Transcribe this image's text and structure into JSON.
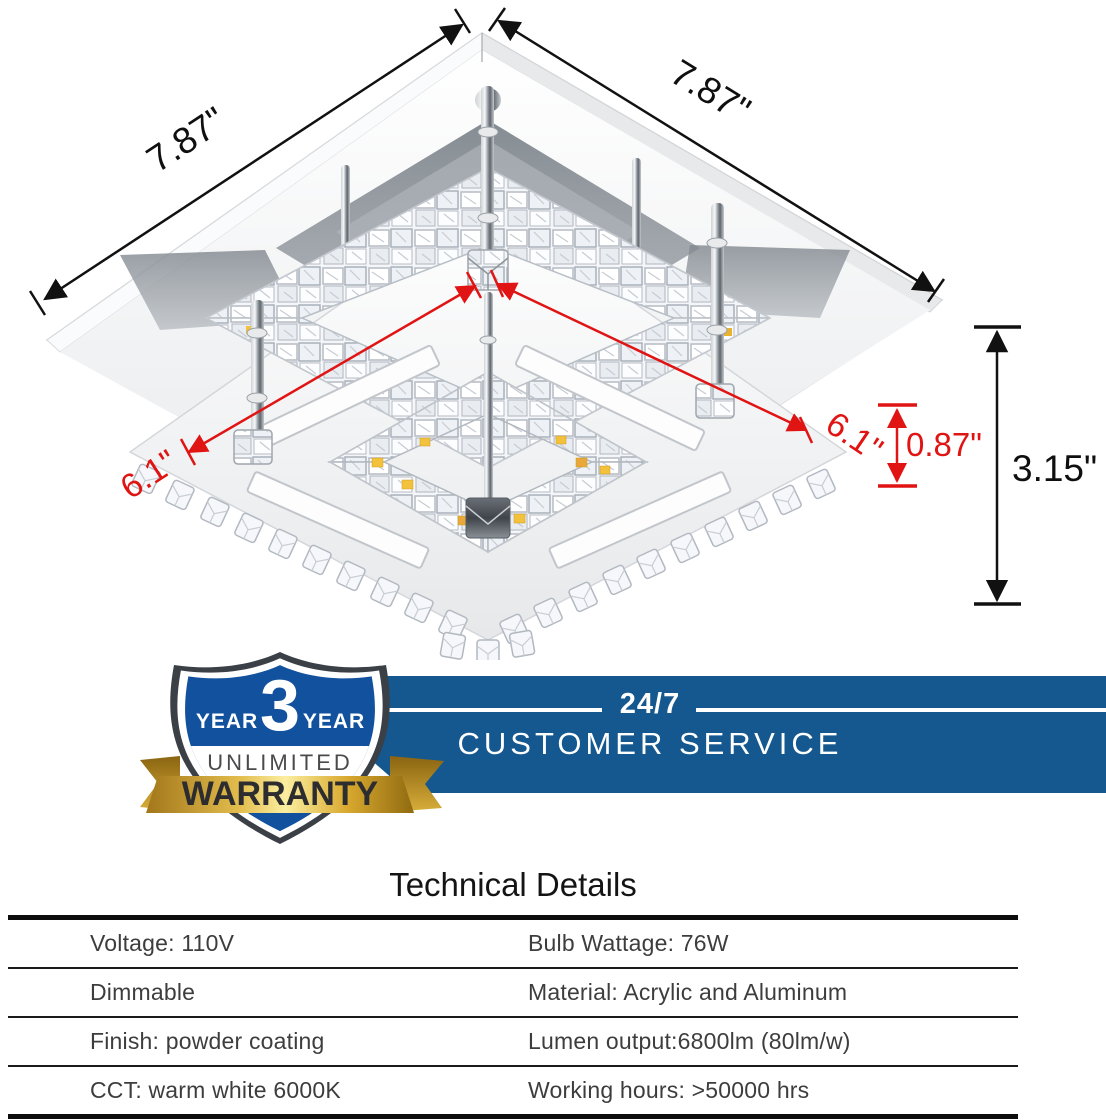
{
  "product_diagram": {
    "description": "crystal-led-flush-mount-ceiling-light",
    "dimensions": {
      "top_left_width": "7.87\"",
      "top_right_depth": "7.87\"",
      "inner_edge_left": "6.1\"",
      "inner_edge_right": "6.1\"",
      "ring_height": "0.87\"",
      "total_height": "3.15\""
    },
    "colors": {
      "dimension_black": "#111111",
      "dimension_red": "#e11414",
      "led_yellow": "#f2c23c",
      "chrome_gray": "#9aa0a6"
    }
  },
  "badge": {
    "year_left": "YEAR",
    "year_number": "3",
    "year_right": "YEAR",
    "line2": "UNLIMITED",
    "ribbon": "WARRANTY",
    "shield_blue": "#11519d",
    "gold": "#e3bd4e"
  },
  "banner": {
    "line1": "24/7",
    "line2": "CUSTOMER SERVICE",
    "blue": "#15578f"
  },
  "tech": {
    "title": "Technical Details",
    "rows": [
      {
        "left": "Voltage: 110V",
        "right": "Bulb Wattage: 76W"
      },
      {
        "left": "Dimmable",
        "right": "Material: Acrylic and Aluminum"
      },
      {
        "left": "Finish: powder coating",
        "right": "Lumen output:6800lm (80lm/w)"
      },
      {
        "left": "CCT: warm white 6000K",
        "right": "Working hours: >50000 hrs"
      }
    ]
  }
}
